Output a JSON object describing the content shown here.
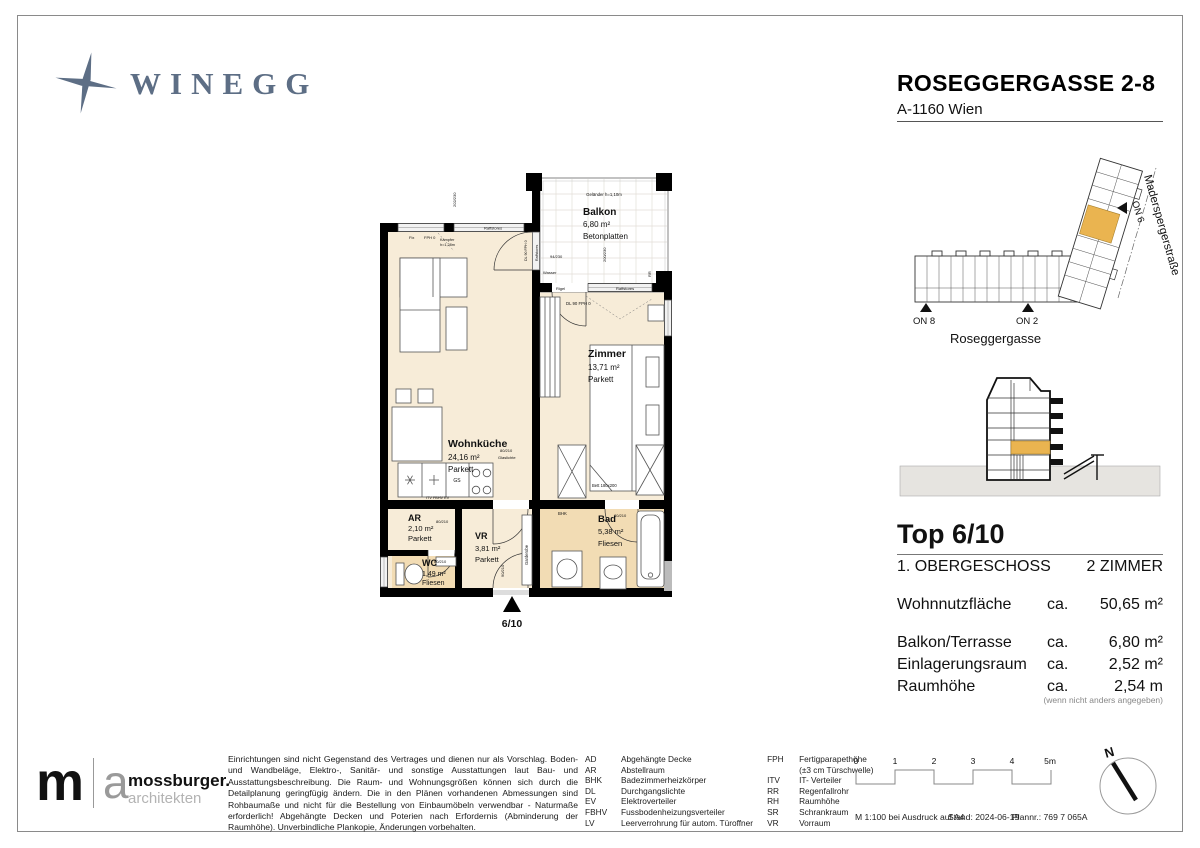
{
  "header": {
    "brand": "WINEGG",
    "project": "ROSEGGERGASSE 2-8",
    "city": "A-1160 Wien"
  },
  "plan": {
    "rooms": {
      "balkon": {
        "name": "Balkon",
        "area": "6,80 m²",
        "floor": "Betonplatten"
      },
      "wohnkueche": {
        "name": "Wohnküche",
        "area": "24,16 m²",
        "floor": "Parkett"
      },
      "zimmer": {
        "name": "Zimmer",
        "area": "13,71 m²",
        "floor": "Parkett"
      },
      "ar": {
        "name": "AR",
        "area": "2,10 m²",
        "floor": "Parkett"
      },
      "vr": {
        "name": "VR",
        "area": "3,81 m²",
        "floor": "Parkett"
      },
      "wc": {
        "name": "WC",
        "area": "1,49 m²",
        "floor": "Fliesen"
      },
      "bad": {
        "name": "Bad",
        "area": "5,38 m²",
        "floor": "Fliesen"
      }
    },
    "annotations": {
      "gelaender": "Geländer h=1,10m",
      "raffstores": "Raffstores",
      "rigel": "Rigel",
      "fix": "Fix",
      "fph0": "FPH 0",
      "kaempfer1": "Kämpfer",
      "kaempfer2": "h=1,28m",
      "dl90": "DL 90",
      "dl90fph0": "DL 90  FPH 0",
      "wasser": "Wasser",
      "glaslichte": "Glaslichte",
      "garderobe": "Garderobe",
      "bhk": "BHK",
      "gs": "GS",
      "itv_fbhv_ev": "ITV FBHV EV",
      "bett": "Bett 180x200",
      "rr": "RR",
      "unit_marker": "6/10"
    },
    "dims": {
      "d202_230": "202/230",
      "d94_230": "94/230",
      "d200_230": "200/230",
      "d80_210": "80/210",
      "d90_210": "90/210"
    }
  },
  "siteplan": {
    "on8": "ON 8",
    "on2": "ON 2",
    "on6": "ON 6",
    "street_bottom": "Roseggergasse",
    "street_right": "Maderspergerstraße"
  },
  "info": {
    "top": "Top 6/10",
    "floor": "1. OBERGESCHOSS",
    "rooms": "2 ZIMMER",
    "rows": [
      {
        "label": "Wohnnutzfläche",
        "ca": "ca.",
        "value": "50,65 m²"
      },
      {
        "label": "Balkon/Terrasse",
        "ca": "ca.",
        "value": "6,80 m²"
      },
      {
        "label": "Einlagerungsraum",
        "ca": "ca.",
        "value": "2,52 m²"
      },
      {
        "label": "Raumhöhe",
        "ca": "ca.",
        "value": "2,54 m"
      }
    ],
    "note": "(wenn nicht anders angegeben)"
  },
  "footer": {
    "architect": {
      "m": "m",
      "a": "a",
      "name": "mossburger.",
      "sub": "architekten"
    },
    "disclaimer": "Einrichtungen sind nicht Gegenstand des Vertrages und dienen nur als Vorschlag. Boden- und Wandbeläge, Elektro-, Sanitär- und sonstige Ausstattungen laut Bau- und Ausstattungsbeschreibung. Die Raum- und Wohnungsgrößen können sich durch die Detailplanung geringfügig ändern. Die in den Plänen vorhandenen Abmessungen sind Rohbaumaße und nicht für die Bestellung von Einbaumöbeln verwendbar - Naturmaße erforderlich! Abgehängte Decken und Poterien nach Erfordernis (Abminderung der Raumhöhe). Unverbindliche Plankopie, Änderungen vorbehalten.",
    "legend_left": [
      {
        "abbr": "AD",
        "desc": "Abgehängte Decke"
      },
      {
        "abbr": "AR",
        "desc": "Abstellraum"
      },
      {
        "abbr": "BHK",
        "desc": "Badezimmerheizkörper"
      },
      {
        "abbr": "DL",
        "desc": "Durchgangslichte"
      },
      {
        "abbr": "EV",
        "desc": "Elektroverteiler"
      },
      {
        "abbr": "FBHV",
        "desc": "Fussbodenheizungsverteiler"
      },
      {
        "abbr": "LV",
        "desc": "Leerverrohrung für autom. Türoffner"
      }
    ],
    "legend_right": [
      {
        "abbr": "FPH",
        "desc": "Fertigparapethöhe"
      },
      {
        "abbr": "",
        "desc": "(±3 cm Türschwelle)"
      },
      {
        "abbr": "ITV",
        "desc": "IT- Verteiler"
      },
      {
        "abbr": "RR",
        "desc": "Regenfallrohr"
      },
      {
        "abbr": "RH",
        "desc": "Raumhöhe"
      },
      {
        "abbr": "SR",
        "desc": "Schrankraum"
      },
      {
        "abbr": "VR",
        "desc": "Vorraum"
      }
    ],
    "scalebar": {
      "t0": "0",
      "t1": "1",
      "t2": "2",
      "t3": "3",
      "t4": "4",
      "t5": "5m"
    },
    "meta": {
      "scale": "M 1:100 bei Ausdruck auf A4",
      "stand": "Stand: 2024-06-19",
      "plan_no": "Plannr.: 769 7 065A"
    },
    "north": "N"
  },
  "colors": {
    "accent_orange": "#EAB450",
    "room_beige": "#F7ECD8",
    "wet_tan": "#F2DCB4",
    "brand_blue": "#5D6E85",
    "ground_gray": "#E6E4E0"
  }
}
